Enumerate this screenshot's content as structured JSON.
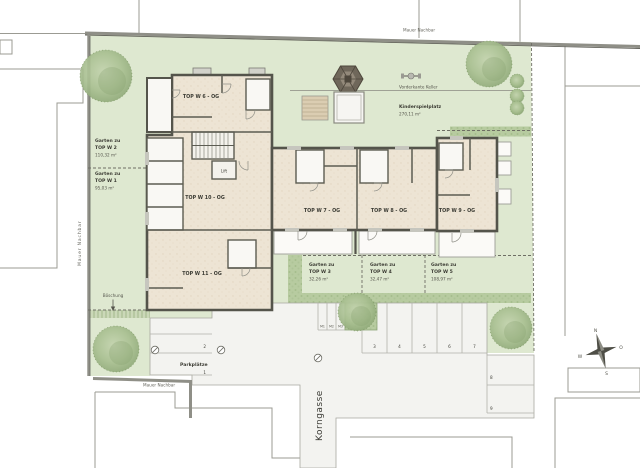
{
  "drawing": {
    "boundary_labels": {
      "top": "Mauer Nachbar",
      "left": "Mauer Nachbar",
      "bottom": "Mauer Nachbar"
    },
    "street_name": "Korngasse",
    "basement_edge_label": "Vorderkante Keller",
    "slope_label": "Böschung",
    "lift_label": "Lift"
  },
  "units": [
    {
      "label": "TOP W 6 - OG"
    },
    {
      "label": "TOP W 10 - OG"
    },
    {
      "label": "TOP W 11 - OG"
    },
    {
      "label": "TOP W 7 - OG"
    },
    {
      "label": "TOP W 8 - OG"
    },
    {
      "label": "TOP W 9 - OG"
    }
  ],
  "gardens": [
    {
      "prefix": "Garten zu",
      "unit": "TOP W 2",
      "area": "110,32 m²"
    },
    {
      "prefix": "Garten zu",
      "unit": "TOP W 1",
      "area": "95,03 m²"
    },
    {
      "prefix": "Garten zu",
      "unit": "TOP W 3",
      "area": "32,26 m²"
    },
    {
      "prefix": "Garten zu",
      "unit": "TOP W 4",
      "area": "32,47 m²"
    },
    {
      "prefix": "Garten zu",
      "unit": "TOP W 5",
      "area": "108,97 m²"
    }
  ],
  "playground": {
    "title": "Kinderspielplatz",
    "area": "270,11 m²"
  },
  "parking": {
    "title": "Parkplätze",
    "spaces": [
      "1",
      "2",
      "3",
      "4",
      "5",
      "6",
      "7",
      "8",
      "9"
    ],
    "moped_spaces": [
      "M1",
      "M2",
      "M3"
    ]
  },
  "compass": {
    "north": "N",
    "east": "O",
    "south": "S",
    "west": "W"
  },
  "colors": {
    "garden_green": "#dee8d0",
    "hedge_green": "#b7cba0",
    "floor_beige": "#ede4d4",
    "wall_dark": "#54544b",
    "paving_grey": "#f3f3f0",
    "terrace_white": "#fbfaf7",
    "line_grey": "#9b9b93"
  }
}
